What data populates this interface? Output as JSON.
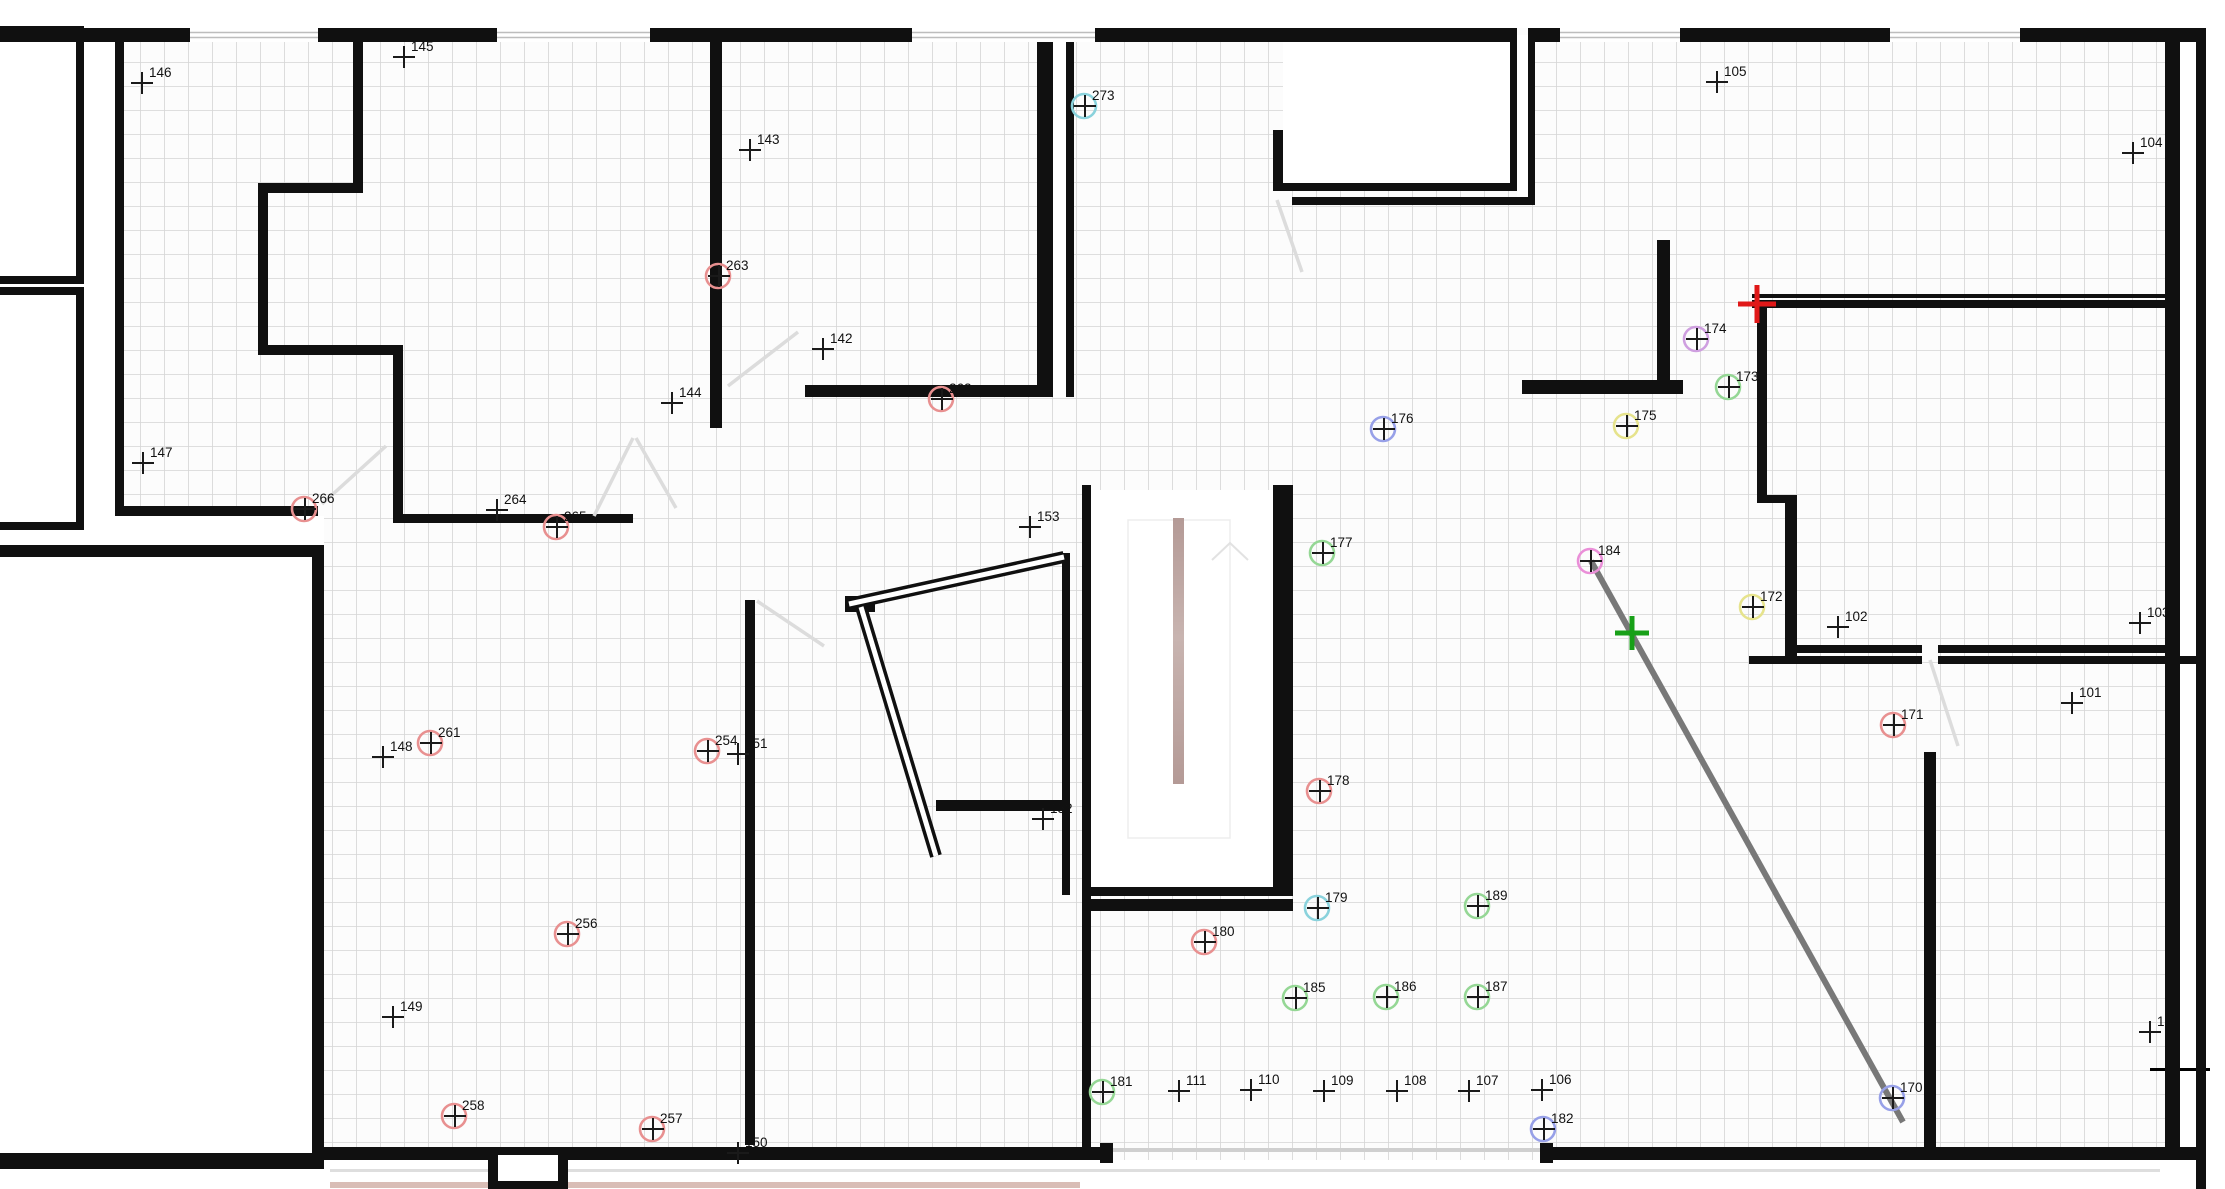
{
  "app": {
    "title": "floor-plan-canvas",
    "view": "2d-plan"
  },
  "canvas": {
    "width": 2225,
    "height": 1189,
    "background": "#ffffff",
    "grid": {
      "size": 24,
      "color": "#d5d5d5",
      "line_width": 1.6,
      "offset_x": 20,
      "offset_y": 14,
      "area_bg": "#fcfcfc"
    }
  },
  "palette": {
    "wall": "#101010",
    "cross": "#1a1a1a",
    "label": "#111111",
    "ring_red": "#e89090",
    "ring_green": "#95d795",
    "ring_cyan": "#8ad2dc",
    "ring_violet": "#cf9fe0",
    "ring_magenta": "#ea8fd8",
    "ring_blue": "#97a0e8",
    "ring_yellow": "#e6e38c",
    "marker_red": "#e01818",
    "marker_green": "#18a018",
    "measure_line": "#787878",
    "door": "#dcdcdc",
    "window_line": "#bdbdbd",
    "stair_stripe_a": "#b49a96",
    "stair_stripe_b": "#c8b4b0",
    "paving_line": "#dedede",
    "rosy_strip": "#d9bdb6"
  },
  "survey_points": [
    {
      "id": "100",
      "x": 2150,
      "y": 1032,
      "ring": null
    },
    {
      "id": "101",
      "x": 2072,
      "y": 703,
      "ring": null
    },
    {
      "id": "102",
      "x": 1838,
      "y": 627,
      "ring": null
    },
    {
      "id": "103",
      "x": 2140,
      "y": 623,
      "ring": null
    },
    {
      "id": "104",
      "x": 2133,
      "y": 153,
      "ring": null
    },
    {
      "id": "105",
      "x": 1717,
      "y": 82,
      "ring": null
    },
    {
      "id": "106",
      "x": 1542,
      "y": 1090,
      "ring": null
    },
    {
      "id": "107",
      "x": 1469,
      "y": 1091,
      "ring": null
    },
    {
      "id": "108",
      "x": 1397,
      "y": 1091,
      "ring": null
    },
    {
      "id": "109",
      "x": 1324,
      "y": 1091,
      "ring": null
    },
    {
      "id": "110",
      "x": 1251,
      "y": 1090,
      "ring": null
    },
    {
      "id": "111",
      "x": 1179,
      "y": 1091,
      "ring": null
    },
    {
      "id": "142",
      "x": 823,
      "y": 349,
      "ring": null
    },
    {
      "id": "143",
      "x": 750,
      "y": 150,
      "ring": null
    },
    {
      "id": "144",
      "x": 672,
      "y": 403,
      "ring": null
    },
    {
      "id": "145",
      "x": 404,
      "y": 57,
      "ring": null
    },
    {
      "id": "146",
      "x": 142,
      "y": 83,
      "ring": null
    },
    {
      "id": "147",
      "x": 143,
      "y": 463,
      "ring": null
    },
    {
      "id": "148",
      "x": 383,
      "y": 757,
      "ring": null
    },
    {
      "id": "149",
      "x": 393,
      "y": 1017,
      "ring": null
    },
    {
      "id": "150",
      "x": 738,
      "y": 1153,
      "ring": null
    },
    {
      "id": "151",
      "x": 738,
      "y": 754,
      "ring": null
    },
    {
      "id": "152",
      "x": 1043,
      "y": 819,
      "ring": null
    },
    {
      "id": "153",
      "x": 1030,
      "y": 527,
      "ring": null
    },
    {
      "id": "170",
      "x": 1893,
      "y": 1098,
      "ring": "blue"
    },
    {
      "id": "171",
      "x": 1894,
      "y": 725,
      "ring": "red"
    },
    {
      "id": "172",
      "x": 1753,
      "y": 607,
      "ring": "yellow"
    },
    {
      "id": "173",
      "x": 1729,
      "y": 387,
      "ring": "green"
    },
    {
      "id": "174",
      "x": 1697,
      "y": 339,
      "ring": "violet"
    },
    {
      "id": "175",
      "x": 1627,
      "y": 426,
      "ring": "yellow"
    },
    {
      "id": "176",
      "x": 1384,
      "y": 429,
      "ring": "blue"
    },
    {
      "id": "177",
      "x": 1323,
      "y": 553,
      "ring": "green"
    },
    {
      "id": "178",
      "x": 1320,
      "y": 791,
      "ring": "red"
    },
    {
      "id": "179",
      "x": 1318,
      "y": 908,
      "ring": "cyan"
    },
    {
      "id": "180",
      "x": 1205,
      "y": 942,
      "ring": "red"
    },
    {
      "id": "181",
      "x": 1103,
      "y": 1092,
      "ring": "green"
    },
    {
      "id": "182",
      "x": 1544,
      "y": 1129,
      "ring": "blue"
    },
    {
      "id": "184",
      "x": 1591,
      "y": 561,
      "ring": "magenta"
    },
    {
      "id": "185",
      "x": 1296,
      "y": 998,
      "ring": "green"
    },
    {
      "id": "186",
      "x": 1387,
      "y": 997,
      "ring": "green"
    },
    {
      "id": "187",
      "x": 1478,
      "y": 997,
      "ring": "green"
    },
    {
      "id": "189",
      "x": 1478,
      "y": 906,
      "ring": "green"
    },
    {
      "id": "254",
      "x": 708,
      "y": 751,
      "ring": "red"
    },
    {
      "id": "256",
      "x": 568,
      "y": 934,
      "ring": "red"
    },
    {
      "id": "257",
      "x": 653,
      "y": 1129,
      "ring": "red"
    },
    {
      "id": "258",
      "x": 455,
      "y": 1116,
      "ring": "red"
    },
    {
      "id": "261",
      "x": 431,
      "y": 743,
      "ring": "red"
    },
    {
      "id": "262",
      "x": 942,
      "y": 399,
      "ring": "red"
    },
    {
      "id": "263",
      "x": 719,
      "y": 276,
      "ring": "red"
    },
    {
      "id": "264",
      "x": 497,
      "y": 510,
      "ring": null
    },
    {
      "id": "265",
      "x": 557,
      "y": 527,
      "ring": "red"
    },
    {
      "id": "266",
      "x": 305,
      "y": 509,
      "ring": "red"
    },
    {
      "id": "273",
      "x": 1085,
      "y": 106,
      "ring": "cyan"
    }
  ],
  "markers": [
    {
      "name": "red-pick-marker",
      "x": 1757,
      "y": 304,
      "size": 19,
      "stroke": 5,
      "color_key": "marker_red"
    },
    {
      "name": "green-pick-marker",
      "x": 1632,
      "y": 633,
      "size": 17,
      "stroke": 5,
      "color_key": "marker_green"
    }
  ],
  "measure_line": {
    "x1": 1591,
    "y1": 561,
    "x2": 1903,
    "y2": 1122,
    "width": 6
  },
  "white_areas": [
    [
      0,
      0,
      2225,
      28
    ],
    [
      0,
      28,
      115,
      1161
    ],
    [
      115,
      516,
      209,
      29
    ],
    [
      12,
      557,
      300,
      596
    ],
    [
      1091,
      490,
      182,
      397
    ],
    [
      1283,
      42,
      227,
      141
    ],
    [
      1517,
      35,
      11,
      170
    ],
    [
      1053,
      42,
      13,
      355
    ],
    [
      2180,
      28,
      45,
      1161
    ],
    [
      0,
      1160,
      2225,
      29
    ]
  ],
  "walls": [
    [
      0,
      28,
      190,
      14
    ],
    [
      318,
      28,
      179,
      14
    ],
    [
      650,
      28,
      262,
      14
    ],
    [
      1095,
      28,
      422,
      14
    ],
    [
      1528,
      28,
      32,
      14
    ],
    [
      1680,
      28,
      210,
      14
    ],
    [
      2020,
      28,
      186,
      14
    ],
    [
      2165,
      28,
      15,
      1132
    ],
    [
      2196,
      28,
      10,
      1161
    ],
    [
      324,
      1147,
      776,
      13
    ],
    [
      1540,
      1147,
      656,
      13
    ],
    [
      1100,
      1143,
      13,
      20
    ],
    [
      1540,
      1143,
      13,
      20
    ],
    [
      0,
      1153,
      324,
      16
    ],
    [
      0,
      26,
      84,
      8
    ],
    [
      76,
      26,
      8,
      258
    ],
    [
      0,
      276,
      84,
      8
    ],
    [
      0,
      287,
      84,
      8
    ],
    [
      76,
      287,
      8,
      243
    ],
    [
      0,
      522,
      84,
      8
    ],
    [
      115,
      28,
      9,
      488
    ],
    [
      353,
      28,
      10,
      162
    ],
    [
      258,
      183,
      105,
      10
    ],
    [
      258,
      183,
      10,
      169
    ],
    [
      258,
      345,
      142,
      10
    ],
    [
      393,
      345,
      10,
      171
    ],
    [
      115,
      506,
      203,
      10
    ],
    [
      393,
      514,
      240,
      9
    ],
    [
      710,
      28,
      12,
      400
    ],
    [
      1037,
      42,
      16,
      355
    ],
    [
      805,
      385,
      248,
      12
    ],
    [
      1066,
      42,
      8,
      355
    ],
    [
      1273,
      183,
      244,
      8
    ],
    [
      1273,
      130,
      10,
      61
    ],
    [
      1510,
      42,
      7,
      149
    ],
    [
      1528,
      35,
      7,
      170
    ],
    [
      1292,
      197,
      243,
      8
    ],
    [
      1657,
      240,
      13,
      150
    ],
    [
      1522,
      380,
      161,
      14
    ],
    [
      1752,
      294,
      413,
      4
    ],
    [
      1752,
      300,
      413,
      8
    ],
    [
      1757,
      300,
      10,
      200
    ],
    [
      1757,
      495,
      40,
      8
    ],
    [
      1785,
      500,
      12,
      158
    ],
    [
      1790,
      645,
      132,
      8
    ],
    [
      1938,
      645,
      227,
      8
    ],
    [
      1749,
      656,
      173,
      8
    ],
    [
      1938,
      656,
      258,
      8
    ],
    [
      1924,
      752,
      12,
      408
    ],
    [
      1082,
      485,
      9,
      410
    ],
    [
      1273,
      485,
      20,
      410
    ],
    [
      1082,
      887,
      211,
      9
    ],
    [
      1082,
      899,
      211,
      12
    ],
    [
      1082,
      895,
      9,
      258
    ],
    [
      1062,
      553,
      8,
      342
    ],
    [
      936,
      800,
      134,
      11
    ],
    [
      745,
      600,
      10,
      545
    ],
    [
      0,
      545,
      324,
      12
    ],
    [
      312,
      545,
      12,
      621
    ],
    [
      845,
      596,
      30,
      16
    ],
    [
      488,
      1147,
      80,
      42
    ]
  ],
  "wall_double_lines": [
    {
      "x1": 849,
      "y1": 604,
      "x2": 1064,
      "y2": 557
    },
    {
      "x1": 861,
      "y1": 607,
      "x2": 936,
      "y2": 856
    }
  ],
  "pillar_core": [
    498,
    1155,
    60,
    26
  ],
  "windows": [
    {
      "x1": 190,
      "x2": 318
    },
    {
      "x1": 497,
      "x2": 650
    },
    {
      "x1": 912,
      "x2": 1095
    },
    {
      "x1": 1560,
      "x2": 1680
    },
    {
      "x1": 1890,
      "x2": 2020
    }
  ],
  "opening_line": [
    1113,
    1148,
    427,
    4
  ],
  "doors": [
    {
      "x1": 322,
      "y1": 504,
      "x2": 386,
      "y2": 446
    },
    {
      "x1": 728,
      "y1": 386,
      "x2": 798,
      "y2": 332
    },
    {
      "x1": 633,
      "y1": 438,
      "x2": 594,
      "y2": 516
    },
    {
      "x1": 636,
      "y1": 438,
      "x2": 676,
      "y2": 508
    },
    {
      "x1": 1277,
      "y1": 200,
      "x2": 1302,
      "y2": 272
    },
    {
      "x1": 1930,
      "y1": 660,
      "x2": 1958,
      "y2": 746
    },
    {
      "x1": 757,
      "y1": 601,
      "x2": 824,
      "y2": 646
    }
  ],
  "stair": {
    "inner_rect": [
      1128,
      520,
      102,
      318
    ],
    "arrow": [
      [
        1212,
        560
      ],
      [
        1230,
        543
      ],
      [
        1248,
        560
      ]
    ],
    "stripe": {
      "x": 1173,
      "y": 518,
      "w": 11,
      "h": 266
    }
  },
  "decor": {
    "paving_line": [
      330,
      1169,
      1830,
      3
    ],
    "rosy_strip": [
      330,
      1182,
      750,
      6
    ],
    "pink_line": [
      2150,
      1068,
      60,
      3
    ]
  }
}
